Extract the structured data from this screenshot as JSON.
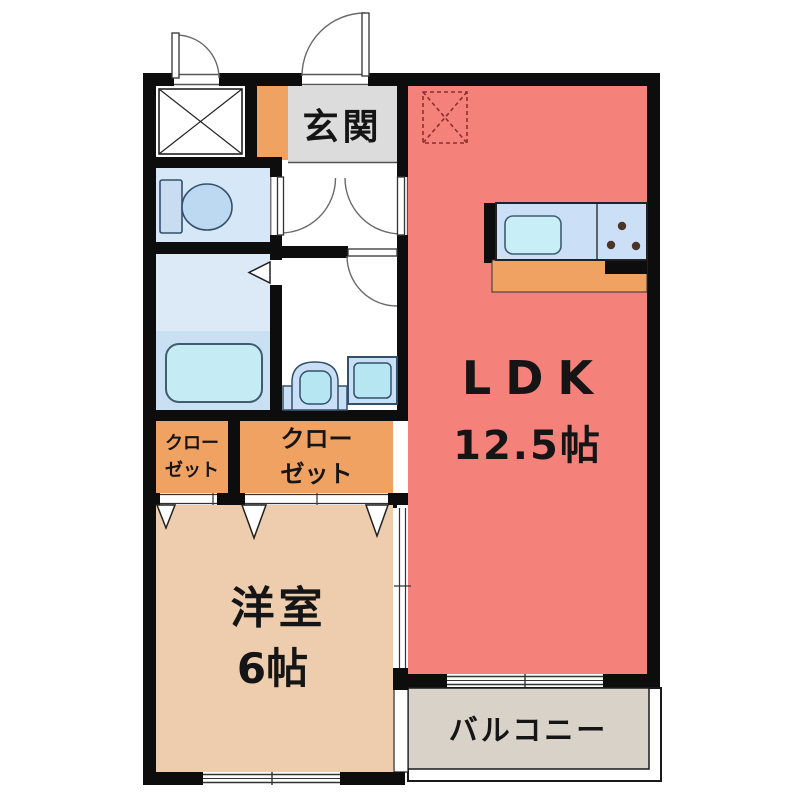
{
  "plan_title": "apartment-floorplan",
  "rooms": {
    "entrance": {
      "label": "玄関"
    },
    "ldk": {
      "name": "LDK",
      "size": "12.5帖"
    },
    "western_room": {
      "name": "洋室",
      "size": "6帖"
    },
    "closet_small": {
      "line1": "クロー",
      "line2": "ゼット"
    },
    "closet_large": {
      "line1": "クロー",
      "line2": "ゼット"
    },
    "balcony": {
      "label": "バルコニー"
    }
  },
  "fixtures": [
    "storage-x-box",
    "refrigerator-space-dashed-box",
    "toilet",
    "bathtub",
    "bath-folding-door-mark",
    "washbasin",
    "washing-machine-pan",
    "kitchen-counter",
    "kitchen-sink",
    "stove-burners",
    "entrance-door",
    "storage-door",
    "toilet-door",
    "hall-ldk-door",
    "washroom-door",
    "closet-folding-doors",
    "sliding-door",
    "windows"
  ],
  "colors": {
    "wall": "#0d0d0d",
    "ldk": "#F5817B",
    "western_room": "#EDCDAE",
    "closet": "#F0A263",
    "entrance_floor": "#F0A263",
    "entrance_hall": "#DCDCDC",
    "toilet_floor": "#D6E7F7",
    "bath_upper": "#DCEAF8",
    "bath_lower": "#C9DFF2",
    "bathtub": "#C5EBF4",
    "kitchen_counter": "#CBE0F6",
    "sink": "#C8EFF7",
    "appliance_blue": "#B5E6F2",
    "balcony": "#D9D2C8",
    "burner": "#4A3526",
    "dashed_box": "#8A3030"
  }
}
